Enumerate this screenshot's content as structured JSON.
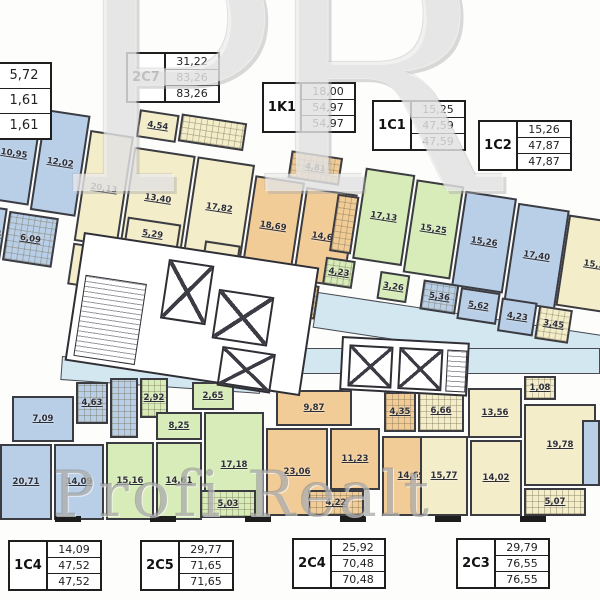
{
  "watermark": {
    "initials": "PR",
    "brand": "Profi Realt"
  },
  "unit_tables": [
    {
      "name": "",
      "values": [
        "5,72",
        "1,61",
        "1,61"
      ],
      "x": -42,
      "y": 62,
      "tall": true
    },
    {
      "name": "2C7",
      "values": [
        "31,22",
        "83,26",
        "83,26"
      ],
      "x": 126,
      "y": 52,
      "tall": false
    },
    {
      "name": "1K1",
      "values": [
        "18,00",
        "54,97",
        "54,97"
      ],
      "x": 262,
      "y": 82,
      "tall": false
    },
    {
      "name": "1C1",
      "values": [
        "15,25",
        "47,59",
        "47,59"
      ],
      "x": 372,
      "y": 100,
      "tall": false
    },
    {
      "name": "1C2",
      "values": [
        "15,26",
        "47,87",
        "47,87"
      ],
      "x": 478,
      "y": 120,
      "tall": false
    },
    {
      "name": "1C4",
      "values": [
        "14,09",
        "47,52",
        "47,52"
      ],
      "x": 8,
      "y": 540,
      "tall": false
    },
    {
      "name": "2C5",
      "values": [
        "29,77",
        "71,65",
        "71,65"
      ],
      "x": 140,
      "y": 540,
      "tall": false
    },
    {
      "name": "2C4",
      "values": [
        "25,92",
        "70,48",
        "70,48"
      ],
      "x": 292,
      "y": 538,
      "tall": false
    },
    {
      "name": "2C3",
      "values": [
        "29,79",
        "76,55",
        "76,55"
      ],
      "x": 456,
      "y": 538,
      "tall": false
    }
  ],
  "bands": {
    "top": {
      "left": 0,
      "top": 86,
      "rotation_deg": 8.6,
      "rooms": [
        {
          "label": "10,95",
          "color": "blue",
          "pattern": "",
          "x": 2,
          "y": 16,
          "w": 44,
          "h": 98
        },
        {
          "label": "12,02",
          "color": "blue",
          "pattern": "",
          "x": 48,
          "y": 16,
          "w": 46,
          "h": 102
        },
        {
          "label": "1,44",
          "color": "blue",
          "pattern": "",
          "x": 0,
          "y": 120,
          "w": 26,
          "h": 54
        },
        {
          "label": "6,09",
          "color": "blue",
          "pattern": "tile",
          "x": 28,
          "y": 122,
          "w": 50,
          "h": 50
        },
        {
          "label": "20,13",
          "color": "cream",
          "pattern": "",
          "x": 96,
          "y": 30,
          "w": 44,
          "h": 112
        },
        {
          "label": "4,54",
          "color": "cream",
          "pattern": "",
          "x": 142,
          "y": 2,
          "w": 40,
          "h": 28
        },
        {
          "label": "",
          "color": "cream",
          "pattern": "tile",
          "x": 184,
          "y": 0,
          "w": 66,
          "h": 28
        },
        {
          "label": "13,40",
          "color": "cream",
          "pattern": "",
          "x": 142,
          "y": 40,
          "w": 62,
          "h": 96
        },
        {
          "label": "17,82",
          "color": "cream",
          "pattern": "",
          "x": 206,
          "y": 40,
          "w": 58,
          "h": 96
        },
        {
          "label": "5,29",
          "color": "cream",
          "pattern": "",
          "x": 146,
          "y": 110,
          "w": 54,
          "h": 28
        },
        {
          "label": "8,29",
          "color": "cream",
          "pattern": "",
          "x": 96,
          "y": 144,
          "w": 44,
          "h": 42
        },
        {
          "label": "2,50",
          "color": "cream",
          "pattern": "",
          "x": 142,
          "y": 140,
          "w": 38,
          "h": 30
        },
        {
          "label": "5,05",
          "color": "cream",
          "pattern": "",
          "x": 226,
          "y": 122,
          "w": 36,
          "h": 30
        },
        {
          "label": "4,81",
          "color": "orange",
          "pattern": "tile",
          "x": 298,
          "y": 20,
          "w": 52,
          "h": 28
        },
        {
          "label": "18,69",
          "color": "orange",
          "pattern": "",
          "x": 266,
          "y": 50,
          "w": 50,
          "h": 96
        },
        {
          "label": "14,69",
          "color": "orange",
          "pattern": "",
          "x": 318,
          "y": 54,
          "w": 52,
          "h": 94
        },
        {
          "label": "2,03",
          "color": "orange",
          "pattern": "",
          "x": 256,
          "y": 148,
          "w": 32,
          "h": 34
        },
        {
          "label": "10,35",
          "color": "orange",
          "pattern": "dots",
          "x": 290,
          "y": 150,
          "w": 56,
          "h": 34
        },
        {
          "label": "",
          "color": "orange",
          "pattern": "tile",
          "x": 350,
          "y": 56,
          "w": 22,
          "h": 58
        },
        {
          "label": "17,13",
          "color": "green",
          "pattern": "",
          "x": 374,
          "y": 26,
          "w": 50,
          "h": 92
        },
        {
          "label": "15,25",
          "color": "green",
          "pattern": "",
          "x": 426,
          "y": 30,
          "w": 48,
          "h": 94
        },
        {
          "label": "4,23",
          "color": "green",
          "pattern": "tile",
          "x": 348,
          "y": 120,
          "w": 30,
          "h": 28
        },
        {
          "label": "3,26",
          "color": "green",
          "pattern": "",
          "x": 404,
          "y": 126,
          "w": 30,
          "h": 28
        },
        {
          "label": "15,26",
          "color": "blue",
          "pattern": "",
          "x": 476,
          "y": 34,
          "w": 52,
          "h": 96
        },
        {
          "label": "17,40",
          "color": "blue",
          "pattern": "",
          "x": 530,
          "y": 38,
          "w": 52,
          "h": 100
        },
        {
          "label": "5,36",
          "color": "blue",
          "pattern": "tile",
          "x": 448,
          "y": 128,
          "w": 36,
          "h": 30
        },
        {
          "label": "5,62",
          "color": "blue",
          "pattern": "",
          "x": 486,
          "y": 130,
          "w": 40,
          "h": 32
        },
        {
          "label": "4,23",
          "color": "blue",
          "pattern": "",
          "x": 528,
          "y": 134,
          "w": 36,
          "h": 34
        },
        {
          "label": "3,45",
          "color": "cream",
          "pattern": "tile",
          "x": 566,
          "y": 136,
          "w": 34,
          "h": 34
        },
        {
          "label": "15,36",
          "color": "cream",
          "pattern": "",
          "x": 582,
          "y": 42,
          "w": 70,
          "h": 92
        }
      ]
    },
    "bottom": {
      "left": 0,
      "top": 0,
      "rotation_deg": 0,
      "rooms": [
        {
          "label": "7,09",
          "color": "blue",
          "pattern": "",
          "x": 12,
          "y": 396,
          "w": 62,
          "h": 46
        },
        {
          "label": "4,63",
          "color": "blue",
          "pattern": "tile",
          "x": 76,
          "y": 382,
          "w": 32,
          "h": 42
        },
        {
          "label": "",
          "color": "blue",
          "pattern": "tile",
          "x": 110,
          "y": 378,
          "w": 28,
          "h": 60
        },
        {
          "label": "20,71",
          "color": "blue",
          "pattern": "",
          "x": 0,
          "y": 444,
          "w": 52,
          "h": 76
        },
        {
          "label": "14,09",
          "color": "blue",
          "pattern": "",
          "x": 54,
          "y": 444,
          "w": 50,
          "h": 76
        },
        {
          "label": "2,92",
          "color": "green",
          "pattern": "tile",
          "x": 140,
          "y": 378,
          "w": 28,
          "h": 40
        },
        {
          "label": "2,65",
          "color": "green",
          "pattern": "",
          "x": 192,
          "y": 382,
          "w": 42,
          "h": 28
        },
        {
          "label": "8,25",
          "color": "green",
          "pattern": "",
          "x": 156,
          "y": 412,
          "w": 46,
          "h": 28
        },
        {
          "label": "15,16",
          "color": "green",
          "pattern": "",
          "x": 106,
          "y": 442,
          "w": 48,
          "h": 78
        },
        {
          "label": "14,61",
          "color": "green",
          "pattern": "",
          "x": 156,
          "y": 442,
          "w": 46,
          "h": 78
        },
        {
          "label": "17,18",
          "color": "green",
          "pattern": "",
          "x": 204,
          "y": 412,
          "w": 60,
          "h": 106
        },
        {
          "label": "5,03",
          "color": "green",
          "pattern": "tile",
          "x": 200,
          "y": 490,
          "w": 56,
          "h": 28
        },
        {
          "label": "9,87",
          "color": "orange",
          "pattern": "",
          "x": 276,
          "y": 390,
          "w": 76,
          "h": 36
        },
        {
          "label": "23,06",
          "color": "orange",
          "pattern": "",
          "x": 266,
          "y": 428,
          "w": 62,
          "h": 88
        },
        {
          "label": "11,23",
          "color": "orange",
          "pattern": "",
          "x": 330,
          "y": 428,
          "w": 50,
          "h": 62
        },
        {
          "label": "4,22",
          "color": "orange",
          "pattern": "tile",
          "x": 308,
          "y": 490,
          "w": 56,
          "h": 26
        },
        {
          "label": "14,69",
          "color": "orange",
          "pattern": "",
          "x": 382,
          "y": 436,
          "w": 58,
          "h": 80
        },
        {
          "label": "4,35",
          "color": "orange",
          "pattern": "tile",
          "x": 384,
          "y": 392,
          "w": 32,
          "h": 40
        },
        {
          "label": "6,66",
          "color": "cream",
          "pattern": "tile",
          "x": 418,
          "y": 390,
          "w": 46,
          "h": 42
        },
        {
          "label": "13,56",
          "color": "cream",
          "pattern": "",
          "x": 468,
          "y": 388,
          "w": 54,
          "h": 50
        },
        {
          "label": "1,08",
          "color": "cream",
          "pattern": "tile",
          "x": 524,
          "y": 376,
          "w": 32,
          "h": 24
        },
        {
          "label": "15,77",
          "color": "cream",
          "pattern": "",
          "x": 420,
          "y": 436,
          "w": 48,
          "h": 80
        },
        {
          "label": "14,02",
          "color": "cream",
          "pattern": "",
          "x": 470,
          "y": 440,
          "w": 52,
          "h": 76
        },
        {
          "label": "19,78",
          "color": "cream",
          "pattern": "",
          "x": 524,
          "y": 404,
          "w": 72,
          "h": 82
        },
        {
          "label": "5,07",
          "color": "cream",
          "pattern": "tile",
          "x": 524,
          "y": 488,
          "w": 62,
          "h": 28
        },
        {
          "label": "",
          "color": "blue",
          "pattern": "",
          "x": 582,
          "y": 420,
          "w": 18,
          "h": 66
        }
      ]
    }
  },
  "palette": {
    "blue": "#b9cfe7",
    "cream": "#f3edc9",
    "orange": "#f2cc97",
    "green": "#d7ecb8",
    "corridor": "#d2e7f0",
    "wall": "#3b3b42"
  }
}
